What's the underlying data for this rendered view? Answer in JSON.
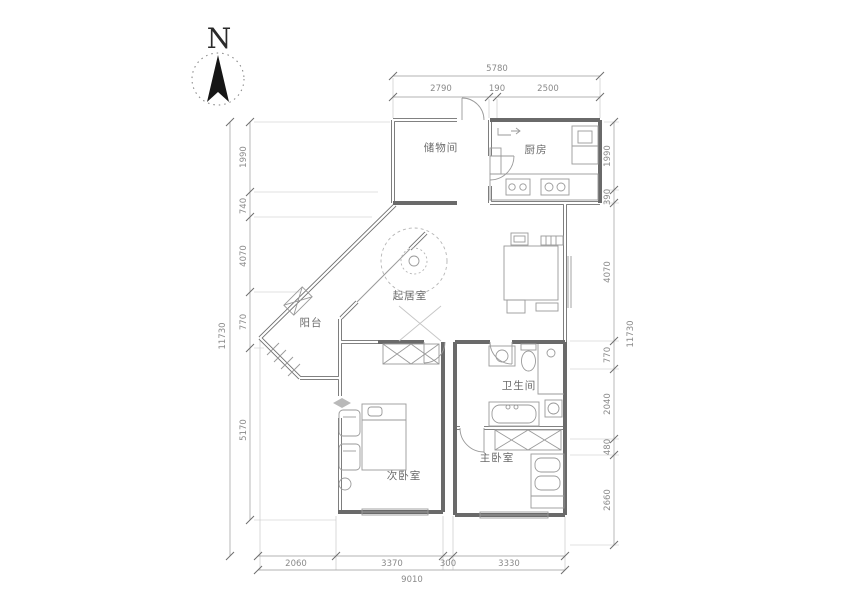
{
  "compass": {
    "label": "N"
  },
  "rooms": {
    "storage": "储物间",
    "kitchen": "厨房",
    "living": "起居室",
    "balcony": "阳台",
    "bathroom": "卫生间",
    "secondary_bedroom": "次卧室",
    "master_bedroom": "主卧室"
  },
  "dimensions": {
    "top": {
      "total": "5780",
      "segments": [
        "2790",
        "190",
        "2500"
      ]
    },
    "bottom": {
      "total": "9010",
      "segments": [
        "2060",
        "3370",
        "300",
        "3330"
      ]
    },
    "left": {
      "total": "11730",
      "segments": [
        "1990",
        "740",
        "4070",
        "770",
        "5170"
      ]
    },
    "right": {
      "total": "11730",
      "segments": [
        "1990",
        "390",
        "4070",
        "770",
        "2040",
        "480",
        "2660"
      ]
    }
  }
}
